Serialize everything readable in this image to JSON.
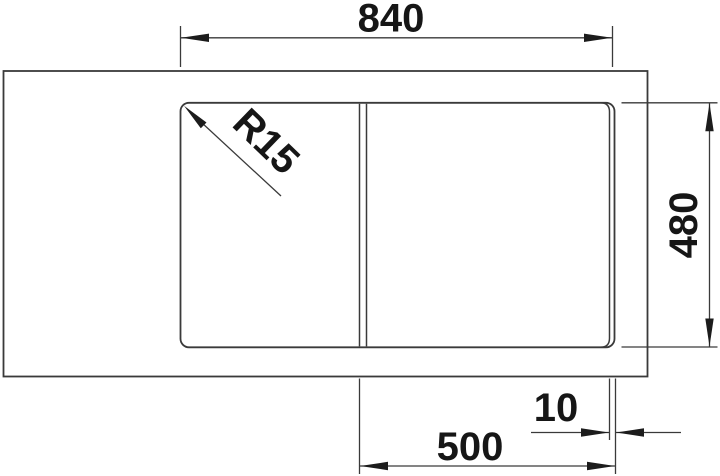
{
  "drawing": {
    "type": "technical-dimension-drawing",
    "subject": "kitchen-sink-top-view",
    "dimensions": {
      "overall_width": "840",
      "depth": "480",
      "bowl_width": "500",
      "edge_offset": "10",
      "corner_radius": "R15"
    },
    "colors": {
      "line": "#3a3a3a",
      "text": "#161616",
      "background": "#ffffff"
    }
  }
}
